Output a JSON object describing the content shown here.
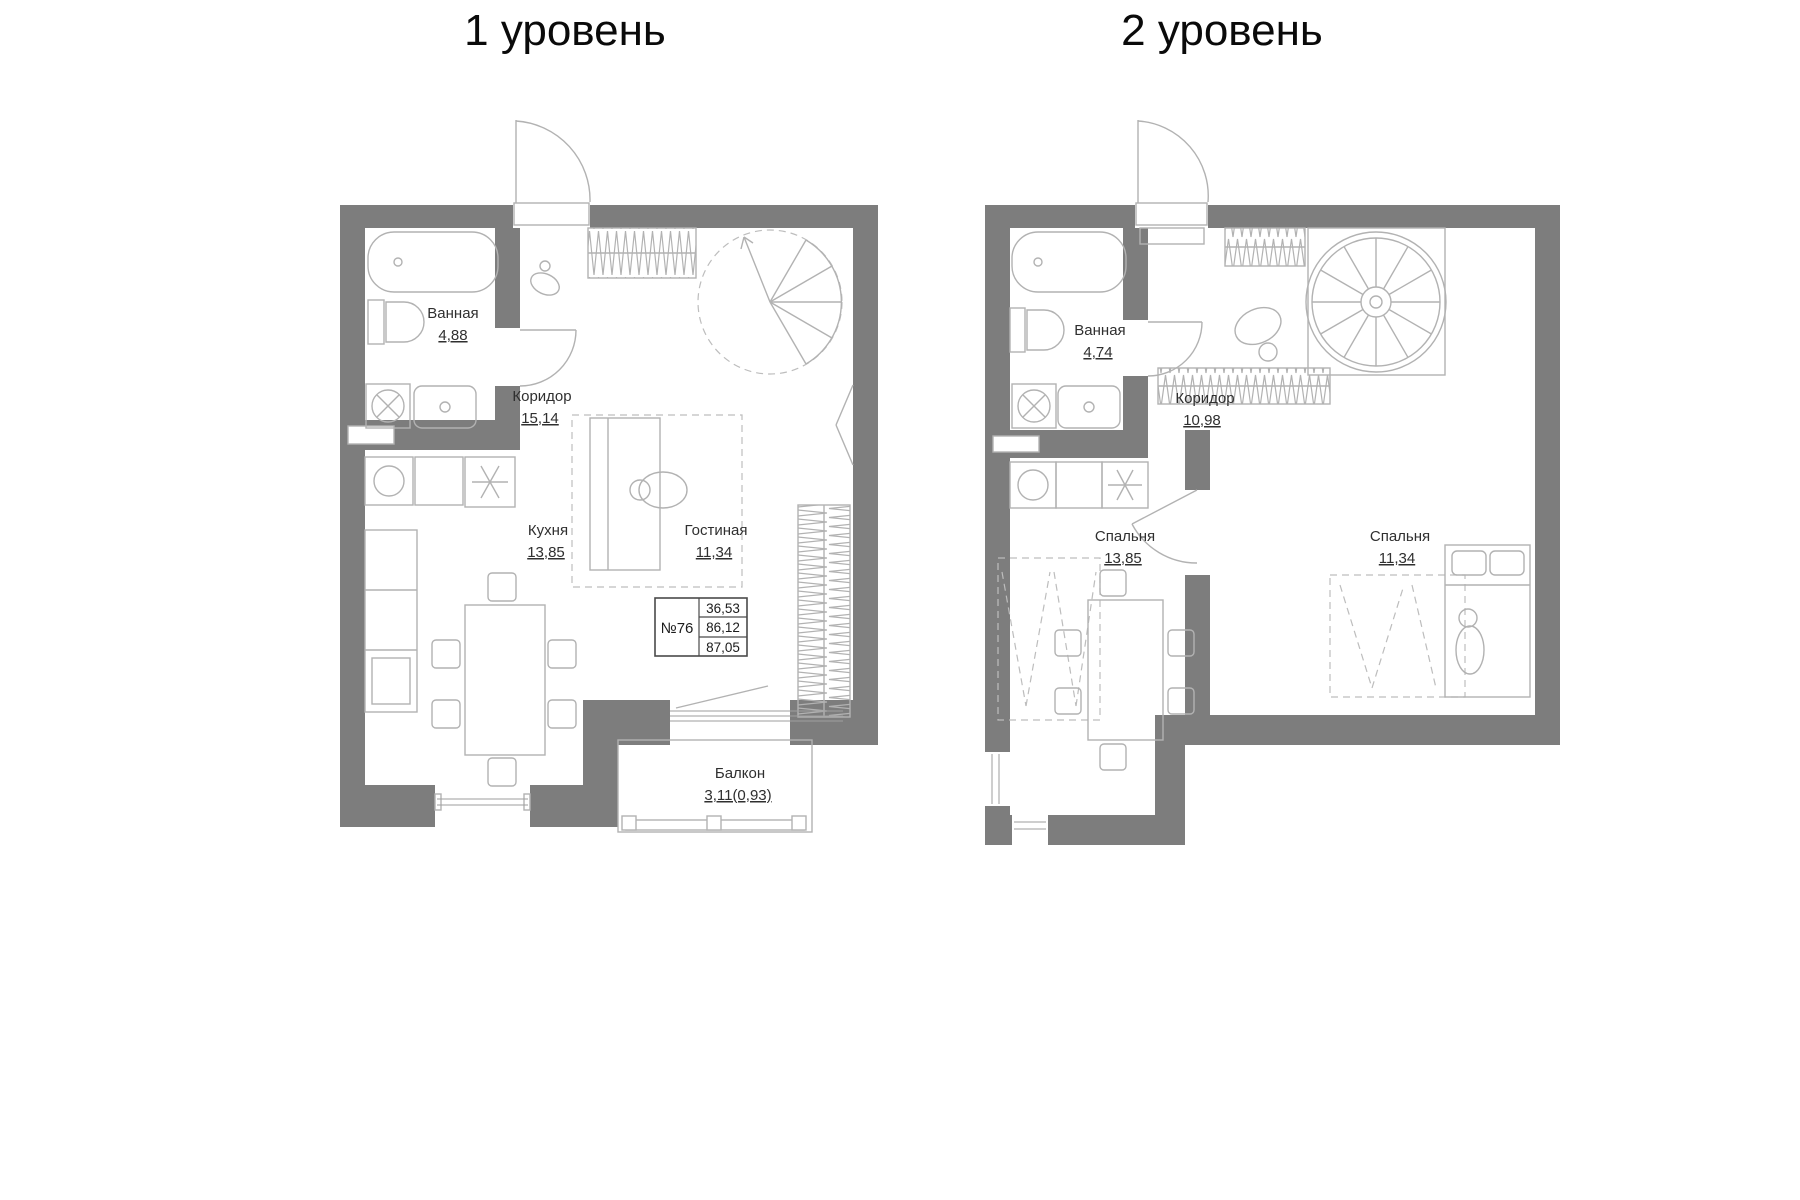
{
  "colors": {
    "wall": "#7d7d7d",
    "furniture_line": "#b2b2b2",
    "label_text": "#2f2f2f"
  },
  "level1": {
    "title": "1 уровень",
    "rooms": {
      "bathroom": {
        "name": "Ванная",
        "area": "4,88"
      },
      "corridor": {
        "name": "Коридор",
        "area": "15,14"
      },
      "kitchen": {
        "name": "Кухня",
        "area": "13,85"
      },
      "living": {
        "name": "Гостиная",
        "area": "11,34"
      },
      "balcony": {
        "name": "Балкон",
        "area": "3,11(0,93)"
      }
    },
    "apartment_info": {
      "number": "№76",
      "area_living": "36,53",
      "area_main": "86,12",
      "area_total": "87,05"
    }
  },
  "level2": {
    "title": "2 уровень",
    "rooms": {
      "bathroom": {
        "name": "Ванная",
        "area": "4,74"
      },
      "corridor": {
        "name": "Коридор",
        "area": "10,98"
      },
      "bedroom1": {
        "name": "Спальня",
        "area": "13,85"
      },
      "bedroom2": {
        "name": "Спальня",
        "area": "11,34"
      }
    }
  }
}
